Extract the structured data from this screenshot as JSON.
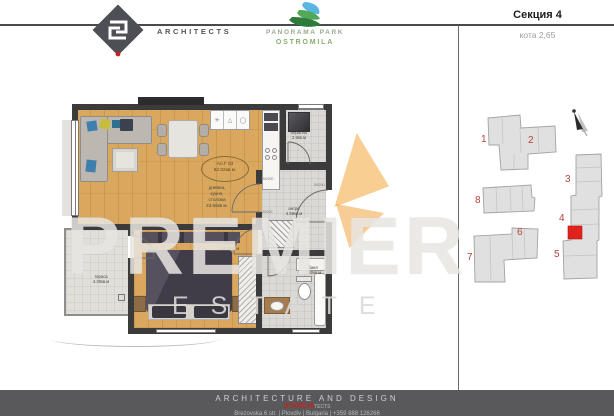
{
  "header": {
    "architects_label": "ARCHITECTS",
    "project": {
      "line1": "PANORAMA PARK",
      "line2": "OSTROMILA"
    },
    "section_title": "Секция 4",
    "elevation_label": "кота 2,65"
  },
  "plan": {
    "apartment": {
      "id": "Ап.Г 03",
      "total_area": "62.02кв м."
    },
    "rooms": {
      "living": {
        "lines": [
          "дневна,",
          "кухня,",
          "столова"
        ],
        "area": "23.66кв м."
      },
      "bedroom": {
        "name": "спалня",
        "area": "14.52кв.м"
      },
      "hallway": {
        "name": "антре",
        "area": "4.59кв.м"
      },
      "bathroom": {
        "name": "баня",
        "area": "4.50кв.м"
      },
      "terrace": {
        "name": "тераса",
        "area": "4.30кв.м"
      },
      "laundry": {
        "name": "перално",
        "area": "2.9кв.м"
      }
    },
    "door_dimensions": [
      "60/200",
      "90/200",
      "90/200"
    ],
    "kitchen_icons": {
      "burner_icon": "✳",
      "hood_icon": "△",
      "sink_icon": "◯"
    }
  },
  "sitemap": {
    "building_numbers": [
      "1",
      "2",
      "3",
      "4",
      "5",
      "6",
      "7",
      "8"
    ],
    "colors": {
      "building_fill": "#e0e0e0",
      "number_red": "#b2423a",
      "highlight_red": "#e0231c"
    }
  },
  "watermark": {
    "word1": "PREMIER",
    "word2": "ESTATE"
  },
  "footer": {
    "tagline": "ARCHITECTURE AND DESIGN",
    "brand_red": "STARCHI",
    "brand_gray": "TECTS",
    "address": "Brezovska 6 str. | Plovdiv | Bulgaria | +359 888 126266"
  },
  "colors": {
    "wall_dark": "#3b3b3c",
    "wood_floor": "#d9a75e",
    "accent_red": "#c0251c",
    "brand_green": "#8bab70",
    "watermark_orange": "#f0a43c"
  }
}
